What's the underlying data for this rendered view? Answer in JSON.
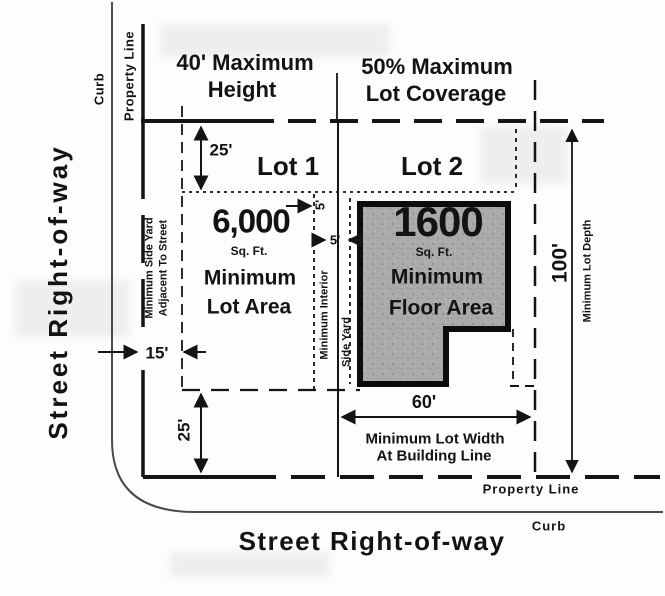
{
  "diagram": {
    "headings": {
      "max_height_line1": "40' Maximum",
      "max_height_line2": "Height",
      "lot_coverage_line1": "50% Maximum",
      "lot_coverage_line2": "Lot Coverage"
    },
    "streets": {
      "left_street": "Street Right-of-way",
      "bottom_street": "Street Right-of-way",
      "left_curb": "Curb",
      "bottom_curb": "Curb",
      "top_property_line": "Property Line",
      "bottom_property_line": "Property Line"
    },
    "lot1": {
      "name": "Lot 1",
      "area_value": "6,000",
      "area_unit": "Sq. Ft.",
      "label_line1": "Minimum",
      "label_line2": "Lot Area"
    },
    "lot2": {
      "name": "Lot 2",
      "floor_value": "1600",
      "floor_unit": "Sq. Ft.",
      "label_line1": "Minimum",
      "label_line2": "Floor Area"
    },
    "dimensions": {
      "rear_setback": "25'",
      "front_setback": "25'",
      "side_yard_street": "15'",
      "interior_side_lot1": "5'",
      "interior_side_lot2": "5'",
      "lot_width": "60'",
      "lot_depth": "100'"
    },
    "annotations": {
      "side_yard_left_line1": "Minimum Side Yard",
      "side_yard_left_line2": "Adjacent To Street",
      "interior_line1": "Minimum Interior",
      "interior_line2": "Side Yard",
      "lot_width_line1": "Minimum Lot Width",
      "lot_width_line2": "At Building Line",
      "lot_depth_label": "Minimum Lot Depth"
    }
  }
}
